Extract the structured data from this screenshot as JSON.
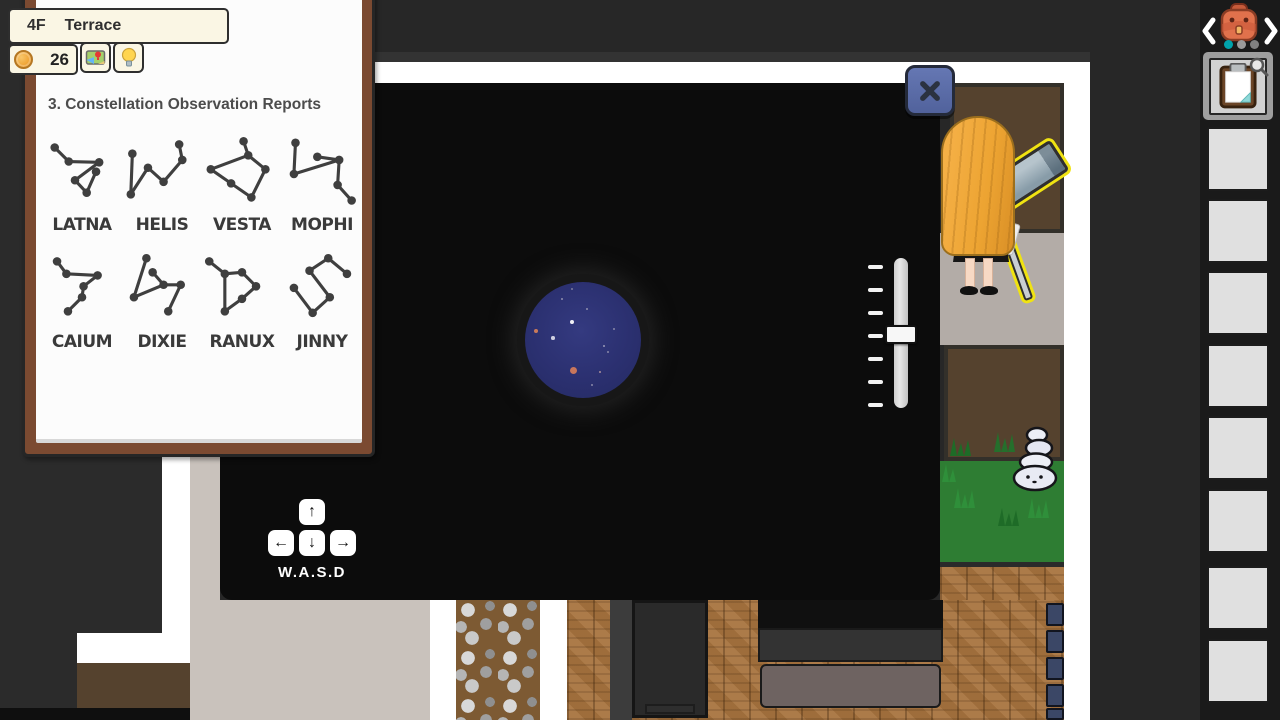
{
  "hud": {
    "floor": "4F",
    "location": "Terrace",
    "coins": "26",
    "map_button_icon": "map-icon",
    "hint_button_icon": "lightbulb-icon"
  },
  "report": {
    "title": "3. Constellation Observation Reports",
    "constellations": [
      {
        "name": "LATNA",
        "points": [
          [
            15,
            16
          ],
          [
            33,
            34
          ],
          [
            72,
            35
          ],
          [
            41,
            58
          ],
          [
            56,
            74
          ],
          [
            68,
            47
          ]
        ],
        "edges": [
          [
            0,
            1
          ],
          [
            1,
            2
          ],
          [
            2,
            3
          ],
          [
            3,
            4
          ],
          [
            4,
            5
          ]
        ]
      },
      {
        "name": "HELIS",
        "points": [
          [
            12,
            24
          ],
          [
            10,
            76
          ],
          [
            32,
            42
          ],
          [
            52,
            60
          ],
          [
            72,
            12
          ],
          [
            76,
            32
          ]
        ],
        "edges": [
          [
            0,
            1
          ],
          [
            1,
            2
          ],
          [
            2,
            3
          ],
          [
            3,
            5
          ],
          [
            5,
            4
          ]
        ]
      },
      {
        "name": "VESTA",
        "points": [
          [
            52,
            8
          ],
          [
            58,
            26
          ],
          [
            10,
            44
          ],
          [
            36,
            62
          ],
          [
            62,
            80
          ],
          [
            80,
            44
          ]
        ],
        "edges": [
          [
            0,
            1
          ],
          [
            1,
            2
          ],
          [
            2,
            3
          ],
          [
            3,
            4
          ],
          [
            4,
            5
          ],
          [
            5,
            1
          ]
        ]
      },
      {
        "name": "MOPHI",
        "points": [
          [
            16,
            10
          ],
          [
            14,
            50
          ],
          [
            44,
            28
          ],
          [
            72,
            32
          ],
          [
            70,
            64
          ],
          [
            88,
            84
          ]
        ],
        "edges": [
          [
            0,
            1
          ],
          [
            1,
            3
          ],
          [
            2,
            3
          ],
          [
            3,
            4
          ],
          [
            4,
            5
          ]
        ]
      },
      {
        "name": "CAIUM",
        "points": [
          [
            18,
            12
          ],
          [
            30,
            28
          ],
          [
            70,
            30
          ],
          [
            52,
            44
          ],
          [
            50,
            58
          ],
          [
            32,
            76
          ]
        ],
        "edges": [
          [
            0,
            1
          ],
          [
            1,
            2
          ],
          [
            2,
            3
          ],
          [
            3,
            4
          ],
          [
            4,
            5
          ]
        ]
      },
      {
        "name": "DIXIE",
        "points": [
          [
            30,
            8
          ],
          [
            14,
            58
          ],
          [
            38,
            26
          ],
          [
            52,
            42
          ],
          [
            74,
            42
          ],
          [
            58,
            76
          ]
        ],
        "edges": [
          [
            0,
            1
          ],
          [
            1,
            3
          ],
          [
            2,
            3
          ],
          [
            3,
            4
          ],
          [
            4,
            5
          ]
        ]
      },
      {
        "name": "RANUX",
        "points": [
          [
            8,
            12
          ],
          [
            28,
            28
          ],
          [
            50,
            26
          ],
          [
            68,
            44
          ],
          [
            28,
            76
          ],
          [
            50,
            60
          ]
        ],
        "edges": [
          [
            0,
            1
          ],
          [
            1,
            2
          ],
          [
            2,
            3
          ],
          [
            1,
            4
          ],
          [
            4,
            5
          ],
          [
            5,
            3
          ]
        ]
      },
      {
        "name": "JINNY",
        "points": [
          [
            58,
            8
          ],
          [
            34,
            24
          ],
          [
            82,
            28
          ],
          [
            14,
            46
          ],
          [
            60,
            58
          ],
          [
            38,
            78
          ]
        ],
        "edges": [
          [
            2,
            0
          ],
          [
            0,
            1
          ],
          [
            1,
            4
          ],
          [
            4,
            5
          ],
          [
            5,
            3
          ]
        ]
      }
    ]
  },
  "scope": {
    "close_icon": "close-x-icon",
    "movement_hint": "W.A.S.D",
    "keys": [
      "↑",
      "←",
      "↓",
      "→"
    ],
    "slider": {
      "ticks": 7,
      "active_tick": 3
    },
    "sky_color": "#2b3070",
    "stars": [
      {
        "x": 47,
        "y": 40,
        "r": 2.2,
        "color": "#f0f0f5"
      },
      {
        "x": 11,
        "y": 49,
        "r": 2.2,
        "color": "#c97a5a"
      },
      {
        "x": 28,
        "y": 56,
        "r": 1.8,
        "color": "#cfcfe0"
      },
      {
        "x": 48,
        "y": 88,
        "r": 3.5,
        "color": "#c8765c"
      },
      {
        "x": 62,
        "y": 27,
        "r": 1,
        "color": "#8f8fae"
      },
      {
        "x": 79,
        "y": 64,
        "r": 1,
        "color": "#9a9ab8"
      },
      {
        "x": 83,
        "y": 70,
        "r": 1,
        "color": "#8888a8"
      },
      {
        "x": 75,
        "y": 90,
        "r": 1.4,
        "color": "#a88f9a"
      },
      {
        "x": 37,
        "y": 17,
        "r": 1,
        "color": "#8f8fae"
      },
      {
        "x": 89,
        "y": 47,
        "r": 1,
        "color": "#8888a8"
      },
      {
        "x": 47,
        "y": 7,
        "r": 1,
        "color": "#7d7d9c"
      },
      {
        "x": 67,
        "y": 103,
        "r": 1,
        "color": "#8888a8"
      }
    ]
  },
  "sidebar": {
    "prev_icon": "chevron-left-icon",
    "next_icon": "chevron-right-icon",
    "bag_icon": "backpack-icon",
    "page_dots": [
      {
        "active": true
      },
      {
        "active": false
      },
      {
        "active": false
      }
    ],
    "slots": [
      {
        "item": "report-clipboard",
        "magnifier": true
      },
      {},
      {},
      {},
      {},
      {},
      {},
      {},
      {}
    ]
  },
  "map": {
    "dresser_handle": "✕"
  },
  "colors": {
    "accent_teal": "#00a3ac",
    "close_button_blue": "#5b6ca8",
    "highlight_yellow": "#f0e312",
    "sky_navy": "#2b3070",
    "coin_orange": "#f0a638",
    "grass_green": "#2e7d33",
    "wood_brown": "#a8743f",
    "frame_brown": "#7b4a31"
  }
}
